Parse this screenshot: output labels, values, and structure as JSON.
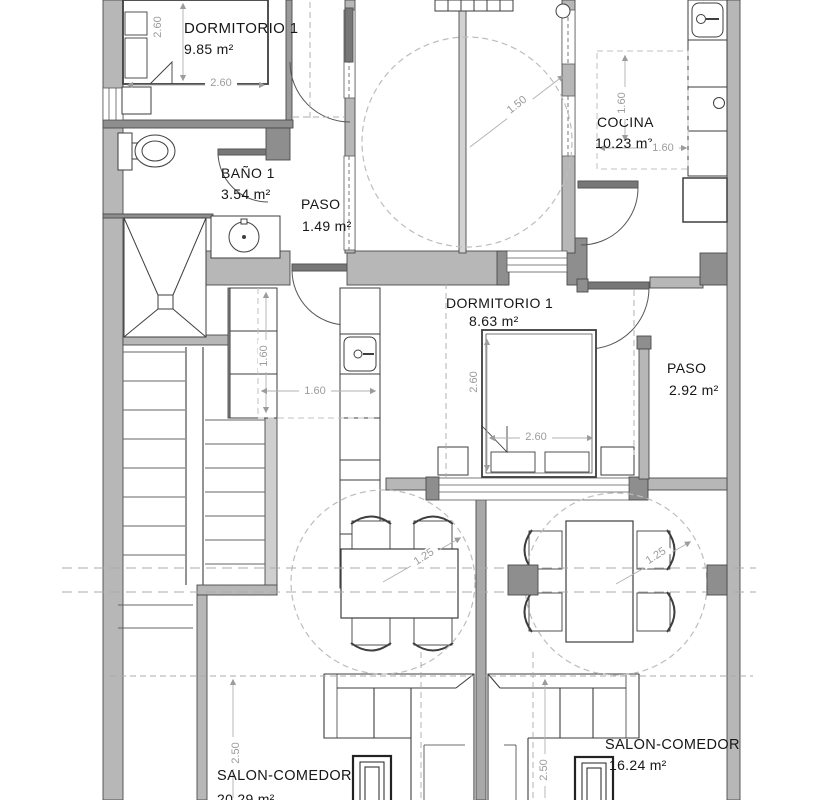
{
  "plan": {
    "rooms": [
      {
        "name": "DORMITORIO 1",
        "area": "9.85 m²"
      },
      {
        "name": "BAÑO 1",
        "area": "3.54 m²"
      },
      {
        "name": "PASO",
        "area": "1.49 m²"
      },
      {
        "name": "COCINA",
        "area": "10.23 m²"
      },
      {
        "name": "DORMITORIO 1",
        "area": "8.63 m²"
      },
      {
        "name": "PASO",
        "area": "2.92 m²"
      },
      {
        "name": "SALON-COMEDOR",
        "area": "20.29 m²"
      },
      {
        "name": "SALON-COMEDOR",
        "area": "16.24 m²"
      }
    ],
    "dims": {
      "d1v": "2.60",
      "d1h": "2.60",
      "terrace": "1.50",
      "cocina_v": "1.60",
      "cocina_h": "1.60",
      "k2_v": "1.60",
      "k2_h": "1.60",
      "d2_v": "2.60",
      "d2_h": "2.60",
      "dining_l": "1.25",
      "dining_r": "1.25",
      "salon_l": "2.50",
      "salon_r": "2.50"
    },
    "colors": {
      "wall": "#b7b7b7",
      "wall_dark": "#8e8e8e",
      "line": "#3e3e3e",
      "dash": "#b5b5b5",
      "dim": "#9c9c9c"
    }
  }
}
